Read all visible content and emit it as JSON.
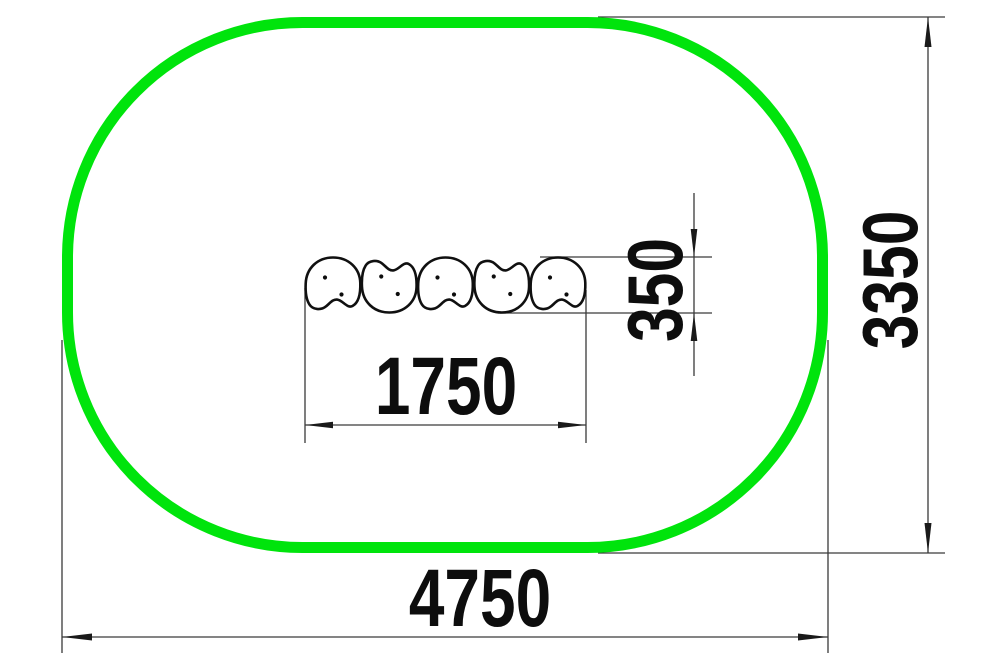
{
  "drawing": {
    "type": "technical-plan-drawing",
    "outline_color": "#00E40C",
    "line_color": "#3a3a3a",
    "pod_count": 5,
    "dimensions": {
      "overall_width": "4750",
      "overall_height": "3350",
      "pod_row_width": "1750",
      "pod_height": "350"
    }
  }
}
